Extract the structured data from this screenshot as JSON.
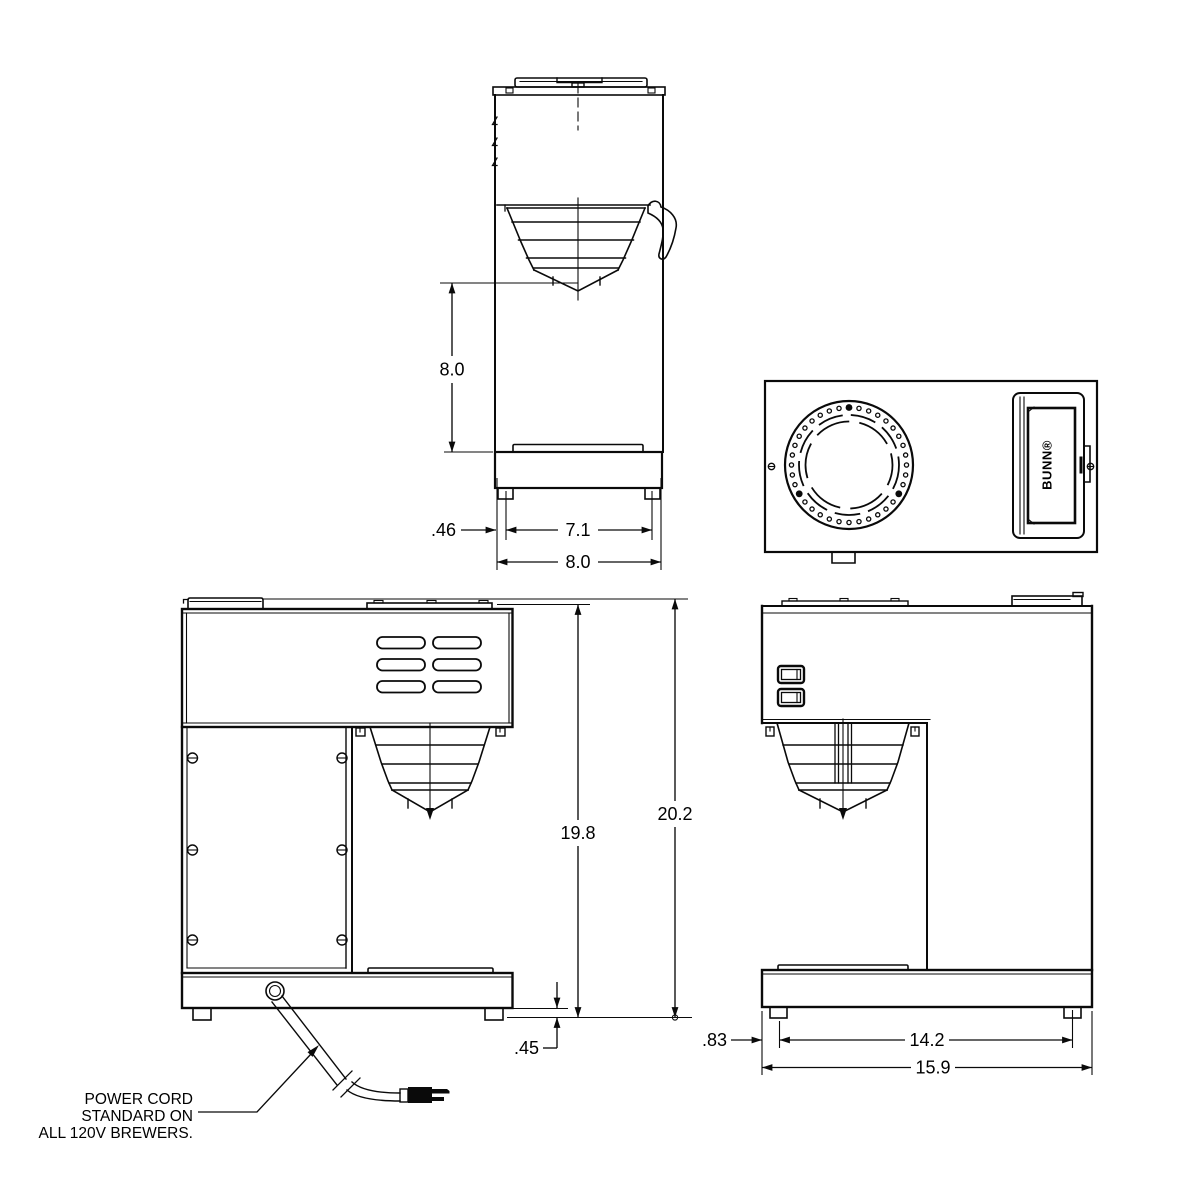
{
  "drawing": {
    "brand": {
      "logo_text": "BUNN®"
    },
    "notes": {
      "power_cord": {
        "line1": "POWER CORD",
        "line2": "STANDARD ON",
        "line3": "ALL 120V BREWERS."
      }
    },
    "dimensions": {
      "side_view": {
        "funnel_clearance": "8.0",
        "foot_inset": ".46",
        "foot_span": "7.1",
        "base_width": "8.0"
      },
      "front_view": {
        "height_to_top": "19.8",
        "overall_height": "20.2",
        "foot_height": ".45"
      },
      "profile_view": {
        "foot_inset": ".83",
        "foot_span": "14.2",
        "base_depth": "15.9"
      }
    },
    "colors": {
      "line": "#000000",
      "background": "#ffffff"
    }
  }
}
